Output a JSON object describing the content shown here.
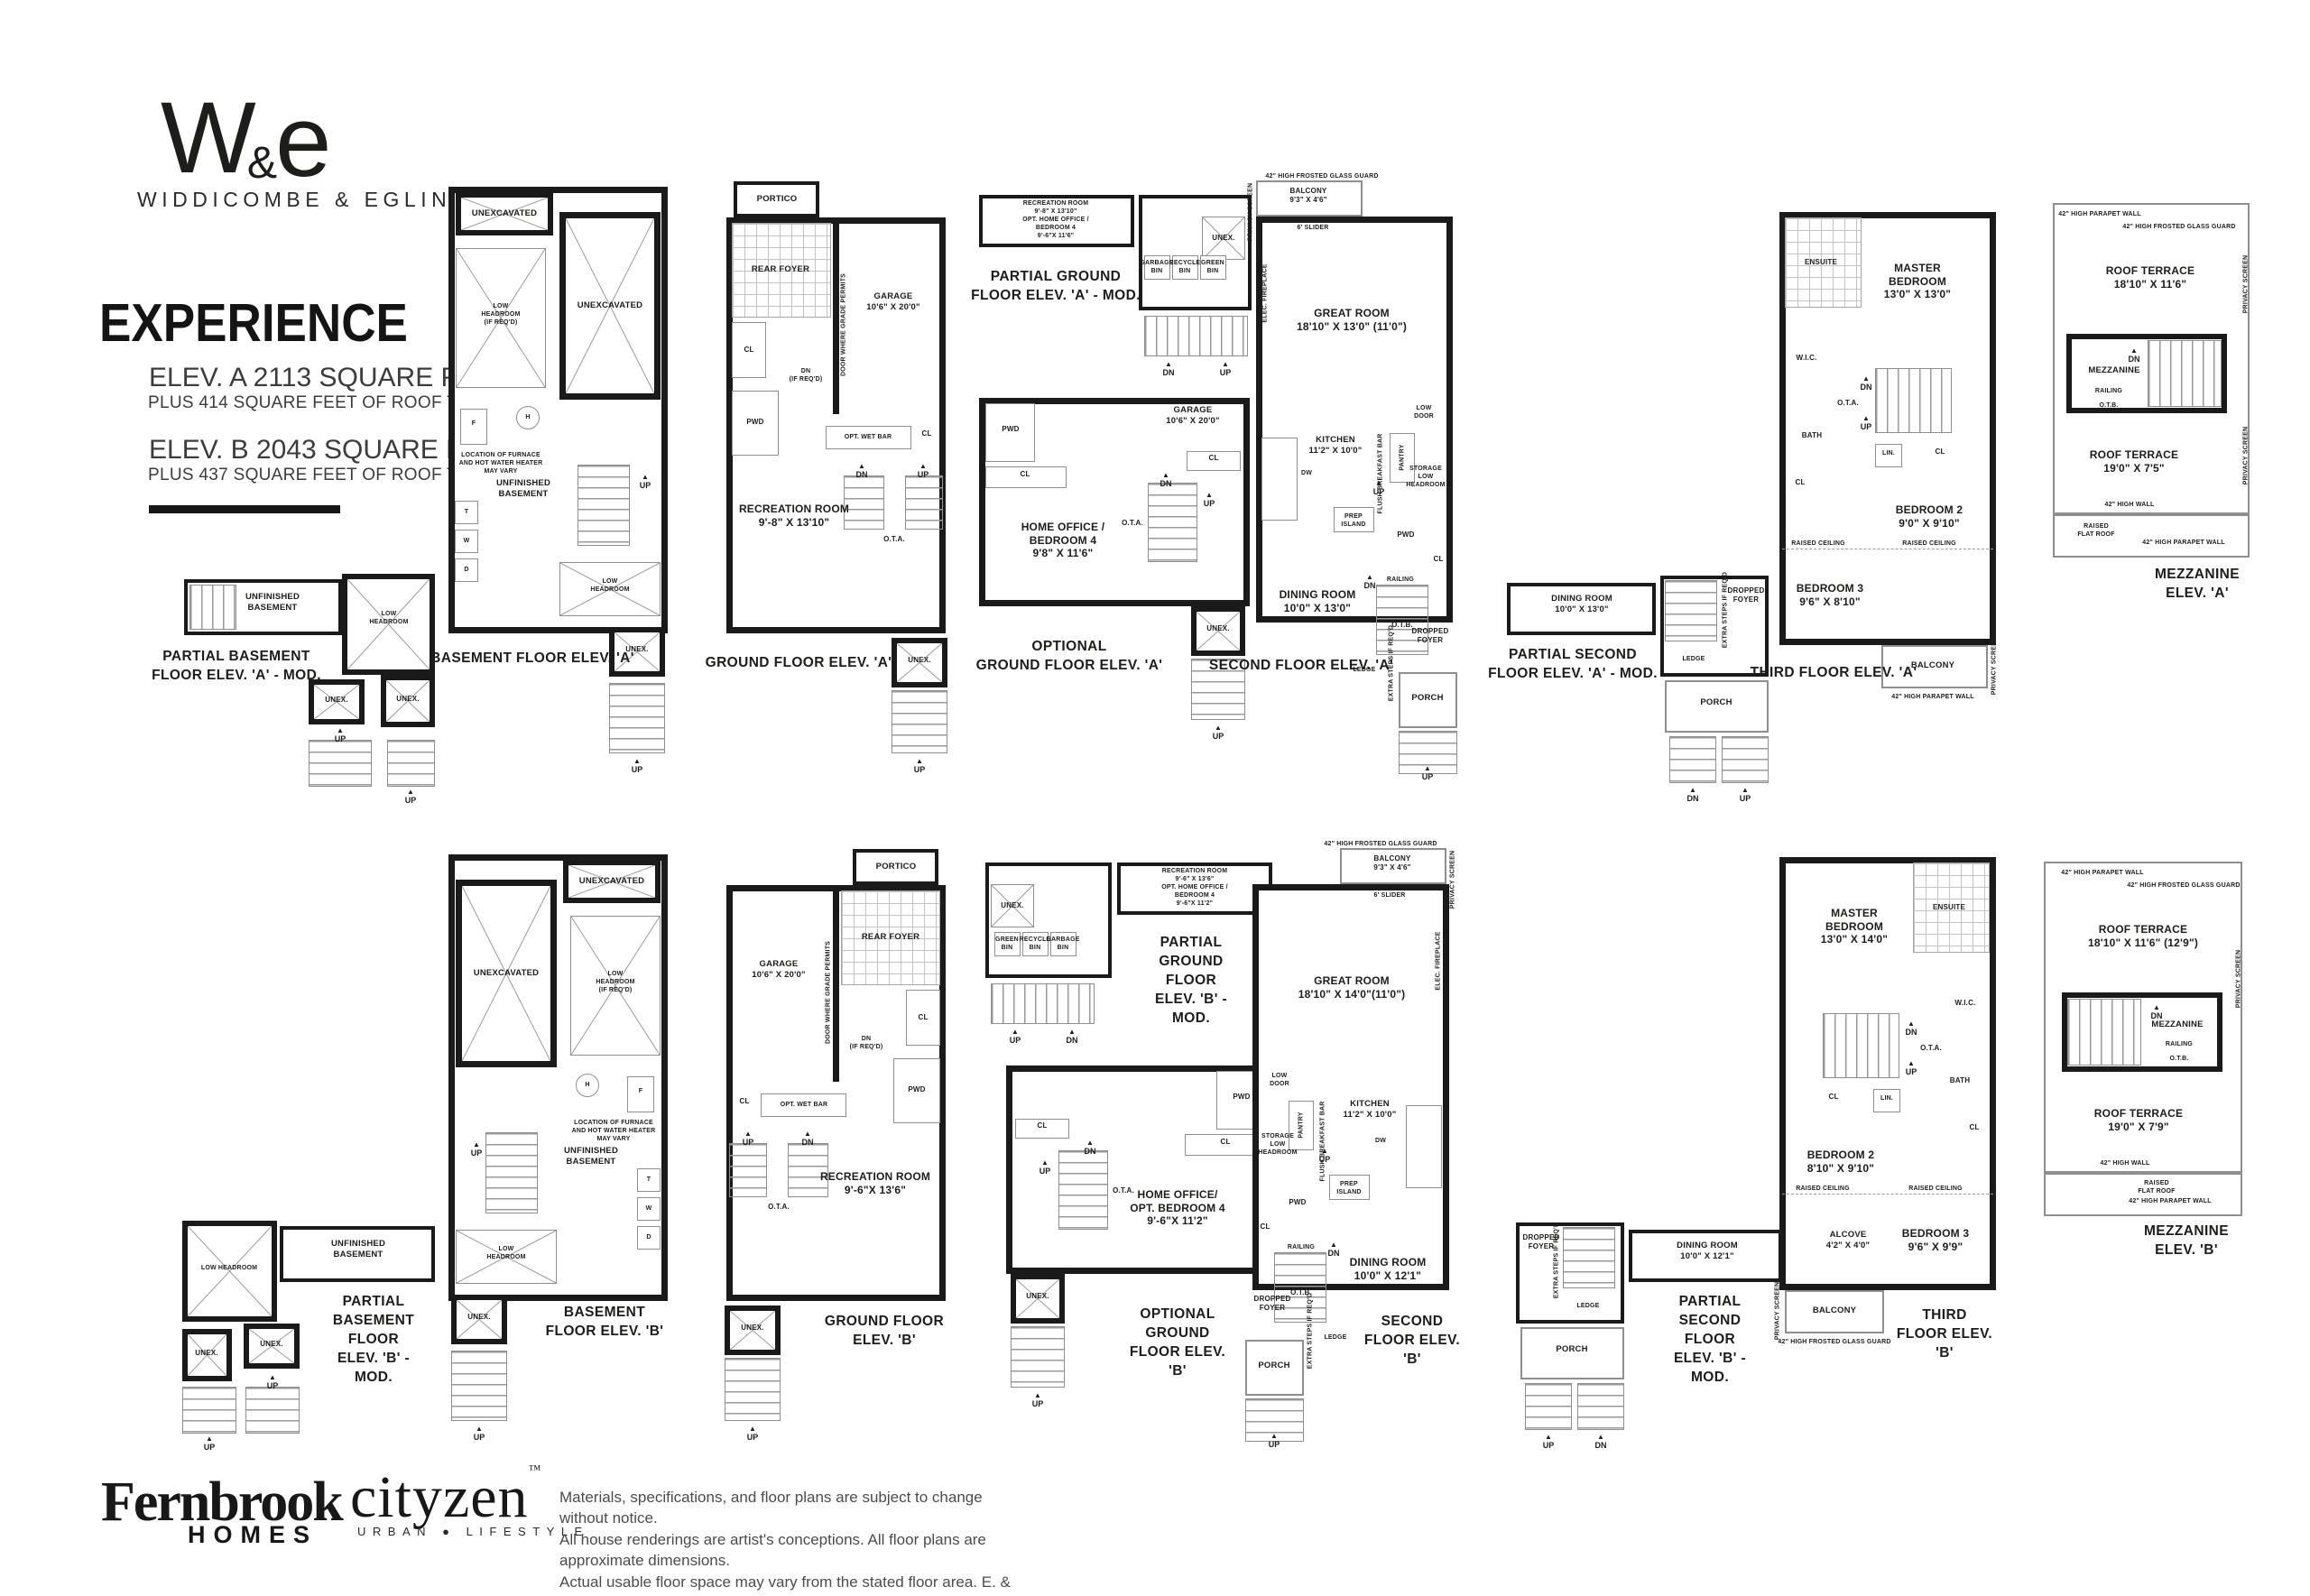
{
  "header": {
    "logo_w": "W",
    "logo_amp": "&",
    "logo_e": "e",
    "logo_name": "WIDDICOMBE & EGLINTON",
    "title": "EXPERIENCE",
    "elev_a": "ELEV. A 2113 SQUARE FEET",
    "elev_a_sub": "PLUS 414 SQUARE FEET OF ROOF TERRACE",
    "elev_b": "ELEV. B 2043 SQUARE FEET",
    "elev_b_sub": "PLUS 437 SQUARE FEET OF ROOF TERRACE"
  },
  "common": {
    "up": "UP",
    "dn": "DN",
    "cl": "CL",
    "unex": "UNEX.",
    "pwd": "PWD",
    "lin": "LIN.",
    "bath": "BATH",
    "wic": "W.I.C.",
    "ensuite": "ENSUITE",
    "ota": "O.T.A.",
    "otb": "O.T.B.",
    "railing": "RAILING",
    "ledge": "LEDGE",
    "porch": "PORCH",
    "portico": "PORTICO",
    "rear_foyer": "REAR FOYER",
    "garage": "GARAGE\n10'6\" X 20'0\"",
    "dn_if_reqd": "DN\n(IF REQ'D)",
    "opt_wet_bar": "OPT. WET BAR",
    "low_headroom": "LOW\nHEADROOM",
    "low_headroom_line": "LOW HEADROOM",
    "low_headroom_reqd": "LOW\nHEADROOM\n(IF REQ'D)",
    "unfinished_basement": "UNFINISHED\nBASEMENT",
    "unexcavated": "UNEXCAVATED",
    "furnace_note": "LOCATION OF FURNACE\nAND HOT WATER HEATER\nMAY VARY",
    "dropped_foyer": "DROPPED\nFOYER",
    "extra_steps": "EXTRA STEPS\nIF REQ'D",
    "privacy_screen": "PRIVACY SCREEN",
    "glass_guard": "42\" HIGH FROSTED GLASS GUARD",
    "parapet": "42\" HIGH PARAPET WALL",
    "high_wall": "42\" HIGH WALL",
    "raised_flat_roof": "RAISED\nFLAT ROOF",
    "raised_ceiling": "RAISED CEILING",
    "mezzanine": "MEZZANINE",
    "elec_fireplace": "ELEC. FIREPLACE",
    "slider": "6' SLIDER",
    "low_door": "LOW\nDOOR",
    "pantry": "PANTRY",
    "storage_lh": "STORAGE\nLOW\nHEADROOM",
    "breakfast_bar": "FLUSH BREAKFAST BAR",
    "prep_island": "PREP\nISLAND",
    "dw": "DW",
    "kitchen": "KITCHEN\n11'2\" X 10'0\"",
    "balcony": "BALCONY",
    "balcony_dim": "BALCONY\n9'3\" X 4'6\"",
    "door_grade": "DOOR WHERE\nGRADE PERMITS",
    "garbage_bin": "GARBAGE\nBIN",
    "recycle_bin": "RECYCLE\nBIN",
    "green_bin": "GREEN\nBIN",
    "f": "F",
    "h": "H",
    "t": "T",
    "w": "W",
    "d": "D"
  },
  "plans": {
    "a1": {
      "caption": "PARTIAL BASEMENT\nFLOOR ELEV. 'A' - MOD."
    },
    "a2": {
      "caption": "BASEMENT FLOOR ELEV. 'A'"
    },
    "a3": {
      "caption": "GROUND FLOOR ELEV. 'A'",
      "rec_room": "RECREATION ROOM\n9'-8\" X 13'10\""
    },
    "a4": {
      "pg_caption": "PARTIAL GROUND\nFLOOR ELEV. 'A' - MOD.",
      "pg_room": "RECREATION ROOM\n9'-8\" X 13'10\"\nOPT. HOME OFFICE /\nBEDROOM 4\n9'-6\"X 11'6\"",
      "og_caption": "OPTIONAL\nGROUND FLOOR ELEV. 'A'",
      "home_office": "HOME OFFICE /\nBEDROOM 4\n9'8\" X 11'6\""
    },
    "a5": {
      "caption": "SECOND FLOOR ELEV. 'A'",
      "great_room": "GREAT ROOM\n18'10\" X 13'0\" (11'0\")",
      "dining": "DINING ROOM\n10'0\" X 13'0\""
    },
    "a6": {
      "caption": "PARTIAL SECOND\nFLOOR ELEV. 'A' - MOD.",
      "dining": "DINING ROOM\n10'0\" X 13'0\""
    },
    "a7": {
      "caption": "THIRD FLOOR ELEV. 'A'",
      "master": "MASTER\nBEDROOM\n13'0\" X 13'0\"",
      "bed2": "BEDROOM 2\n9'0\" X 9'10\"",
      "bed3": "BEDROOM 3\n9'6\" X 8'10\""
    },
    "a8": {
      "caption": "MEZZANINE ELEV. 'A'",
      "terrace1": "ROOF TERRACE\n18'10\" X 11'6\"",
      "terrace2": "ROOF TERRACE\n19'0\" X 7'5\""
    },
    "b1": {
      "caption": "PARTIAL BASEMENT\nFLOOR ELEV. 'B' - MOD."
    },
    "b2": {
      "caption": "BASEMENT FLOOR ELEV. 'B'"
    },
    "b3": {
      "caption": "GROUND FLOOR ELEV. 'B'",
      "rec_room": "RECREATION ROOM\n9'-6\"X 13'6\""
    },
    "b4": {
      "pg_caption": "PARTIAL GROUND\nFLOOR ELEV. 'B' - MOD.",
      "pg_room": "RECREATION ROOM\n9'-6\" X 13'6\"\nOPT. HOME OFFICE / BEDROOM 4\n9'-6\"X 11'2\"",
      "og_caption": "OPTIONAL\nGROUND FLOOR ELEV. 'B'",
      "home_office": "HOME OFFICE/\nOPT. BEDROOM 4\n9'-6\"X 11'2\""
    },
    "b5": {
      "caption": "SECOND FLOOR ELEV. 'B'",
      "great_room": "GREAT ROOM\n18'10\" X 14'0\"(11'0\")",
      "dining": "DINING ROOM\n10'0\" X 12'1\""
    },
    "b6": {
      "caption": "PARTIAL SECOND FLOOR\nELEV. 'B' - MOD.",
      "dining": "DINING ROOM\n10'0\" X 12'1\""
    },
    "b7": {
      "caption": "THIRD FLOOR ELEV. 'B'",
      "master": "MASTER\nBEDROOM\n13'0\" X 14'0\"",
      "bed2": "BEDROOM 2\n8'10\" X 9'10\"",
      "bed3": "BEDROOM 3\n9'6\" X 9'9\"",
      "alcove": "ALCOVE\n4'2\" X 4'0\""
    },
    "b8": {
      "caption": "MEZZANINE ELEV. 'B'",
      "terrace1": "ROOF TERRACE\n18'10\" X 11'6\" (12'9\")",
      "terrace2": "ROOF TERRACE\n19'0\" X 7'9\""
    }
  },
  "footer": {
    "fernbrook": "Fernbrook",
    "fernbrook_sub": "HOMES",
    "cityzen": "cityzen",
    "cityzen_tm": "™",
    "cityzen_sub": "URBAN ● LIFESTYLE",
    "disclaimer_1": "Materials, specifications, and floor plans are subject to change without notice.",
    "disclaimer_2": "All house renderings are artist's conceptions. All floor plans are approximate dimensions.",
    "disclaimer_3": "Actual usable floor space may vary from the stated floor area. E. & O.E.",
    "code": "20-04"
  }
}
